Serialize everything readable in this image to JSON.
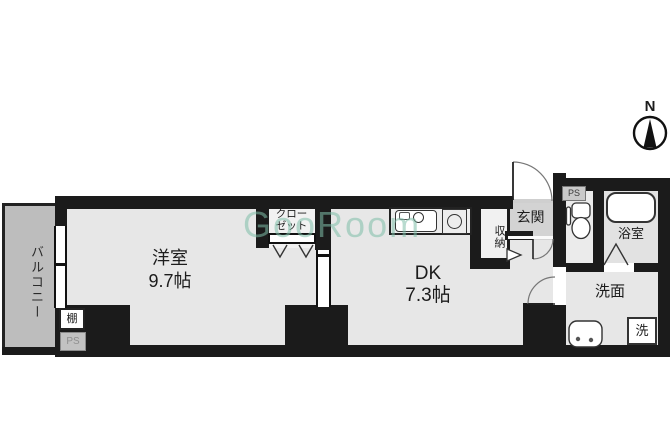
{
  "colors": {
    "wall": "#1b1b1b",
    "room_floor": "#e7e7e7",
    "balcony_floor": "#bdbdbd",
    "entrance_floor": "#d3d3d3",
    "watermark": "#7fbfa9"
  },
  "compass": {
    "north_label": "N"
  },
  "watermark": {
    "text": "GooRoom"
  },
  "rooms": {
    "balcony": {
      "label": "バルコニー"
    },
    "western_room": {
      "label": "洋室",
      "size": "9.7帖"
    },
    "closet": {
      "line1": "クロー",
      "line2": "ゼット"
    },
    "dk": {
      "label": "DK",
      "size": "7.3帖"
    },
    "storage": {
      "label": "収納"
    },
    "entrance": {
      "label": "玄関"
    },
    "bathroom": {
      "label": "浴室"
    },
    "washroom": {
      "label": "洗面"
    },
    "washer": {
      "label": "洗"
    },
    "shelf": {
      "label": "棚"
    },
    "ps_upper": {
      "label": "PS"
    },
    "ps_lower": {
      "label": "PS"
    }
  }
}
